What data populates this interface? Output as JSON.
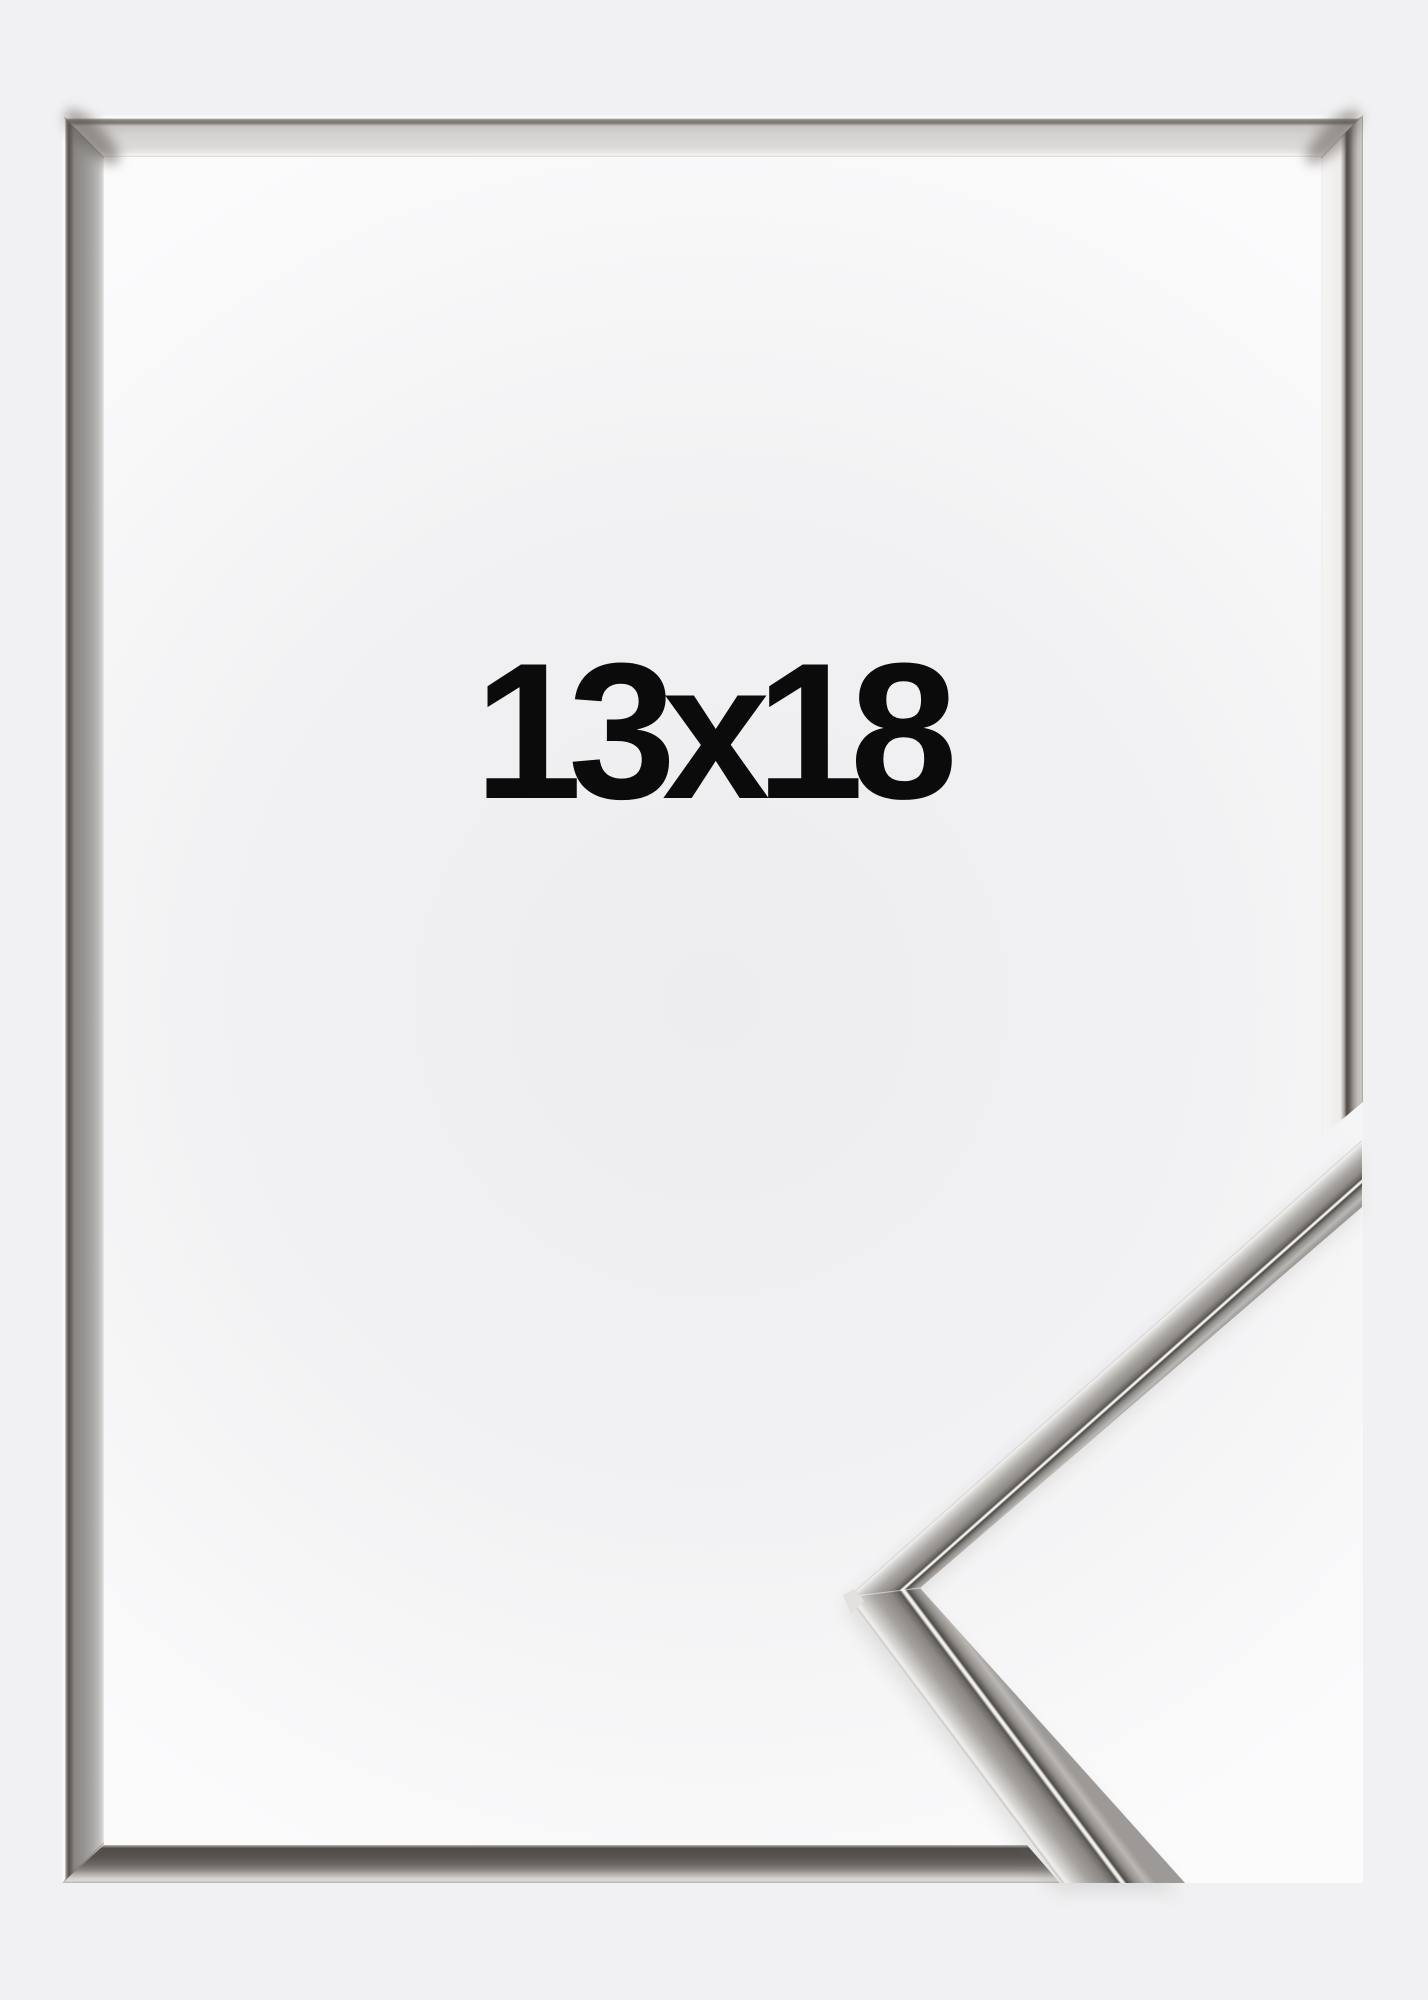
{
  "page": {
    "background_color": "#f1f1f3"
  },
  "product": {
    "size_label": "13x18",
    "label_color": "#0b0b0b",
    "frame_finish": "polished-silver",
    "frame_colors": {
      "outer_highlight": "#fafaf9",
      "face_light": "#d6d4d2",
      "face_mid": "#97918d",
      "reflection_dark": "#4e4945",
      "white_stripe": "#f3f2f0"
    },
    "interior_center_color": "#ededef",
    "interior_edge_color": "#fbfbfc"
  }
}
